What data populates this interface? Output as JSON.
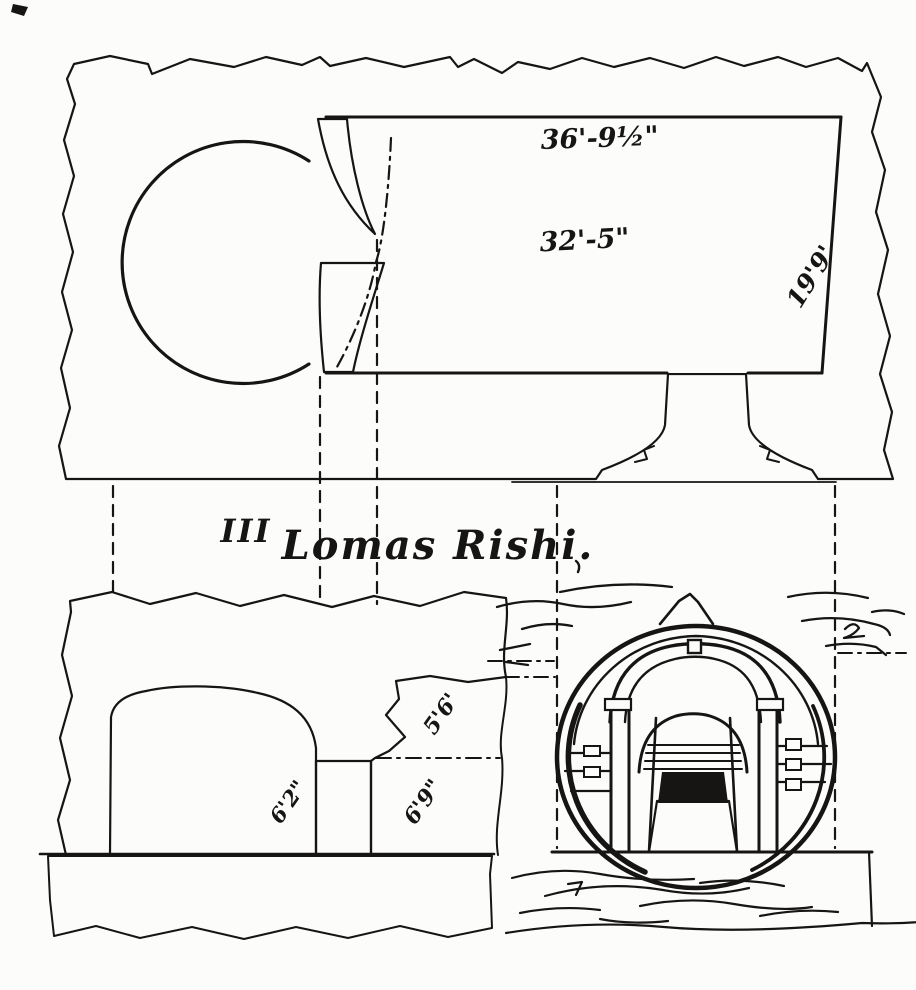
{
  "figure": {
    "number": "III",
    "title": "Lomas Rishi."
  },
  "measurements": {
    "plan": {
      "overall_length": "36'-9½\"",
      "hall_length": "32'-5\"",
      "hall_width": "19'9'"
    },
    "elevation": {
      "cell_height": "6'2\"",
      "porch_upper": "5'6'",
      "porch_lower": "6'9\""
    }
  },
  "colors": {
    "ink": "#161514",
    "paper": "#fcfcfa"
  }
}
